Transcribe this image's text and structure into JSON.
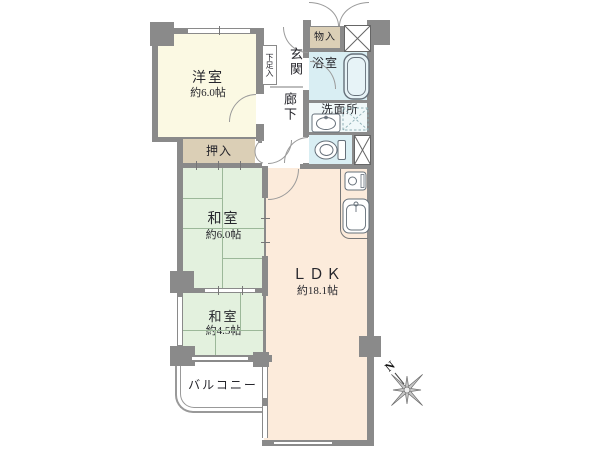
{
  "rooms": {
    "western_room": {
      "label": "洋室",
      "size": "約6.0帖"
    },
    "tatami_6": {
      "label": "和室",
      "size": "約6.0帖"
    },
    "tatami_45": {
      "label": "和室",
      "size": "約4.5帖"
    },
    "ldk": {
      "label": "ＬＤＫ",
      "size": "約18.1帖"
    },
    "closet_oshiire": {
      "label": "押入"
    },
    "storage_monoire": {
      "label": "物入"
    },
    "shoe_storage": {
      "label": "下足入"
    },
    "entrance": {
      "label": "玄関"
    },
    "hallway": {
      "label": "廊下"
    },
    "bathroom": {
      "label": "浴室"
    },
    "washroom": {
      "label": "洗面所"
    },
    "balcony": {
      "label": "バルコニー"
    }
  },
  "compass": {
    "north_label": "N"
  },
  "icons": [
    "double-entry-door",
    "bathtub",
    "washbasin",
    "toilet",
    "washing-machine-space",
    "pipe-space",
    "gas-stove",
    "kitchen-sink",
    "compass-rose"
  ],
  "colors": {
    "wall": "#8a8a8a",
    "western_room": "#fbf9e3",
    "tatami_room": "#e3f1de",
    "closet": "#dbcfb6",
    "ldk": "#fcebdb",
    "wet_area": "#d9eef3",
    "washroom": "#f0f8f9",
    "text": "#26262c"
  }
}
